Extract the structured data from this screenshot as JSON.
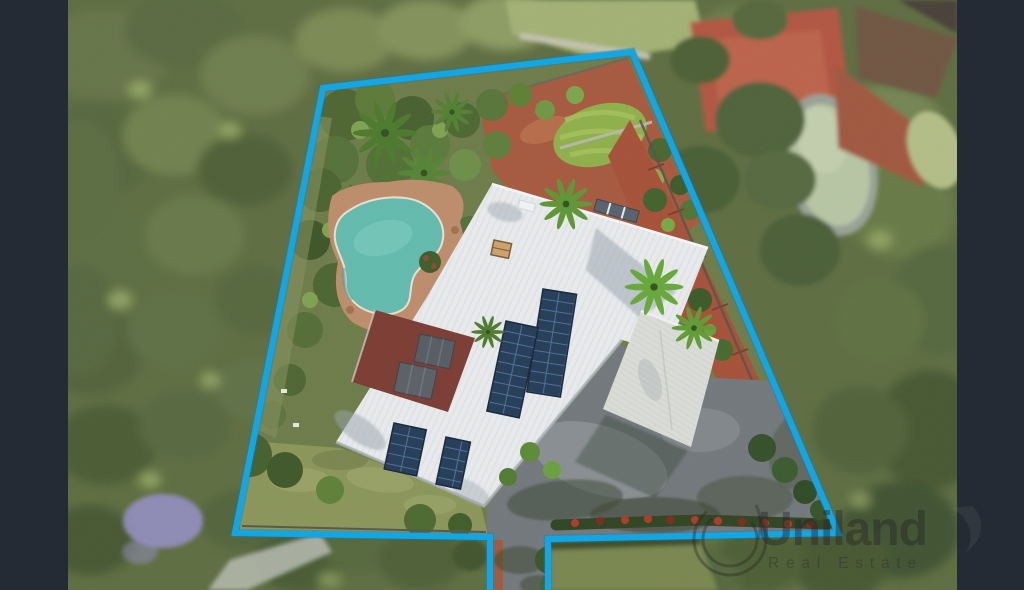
{
  "image": {
    "kind": "aerial drone photograph of a residential property with highlighted lot boundary",
    "width": 1024,
    "height": 590
  },
  "watermark": {
    "brand": "Uniland",
    "tagline": "Real Estate"
  },
  "colors": {
    "frame_bar": "#242b34",
    "boundary": "#14a5e3",
    "house_roof": "#e9ebed",
    "garage_roof": "#dadcd7",
    "solar_panel": "#253c58",
    "pool_water": "#63bbae",
    "pool_paving": "#bd8d6c",
    "pergola_roof": "#7b3c33",
    "driveway": "#73787c",
    "mulch": "#a75a3f",
    "putting_green": "#8fb04c",
    "lawn": "#8b965a",
    "foliage": "#5e6e41",
    "jacaranda": "#948ec2",
    "neighbor_court": "#b25742",
    "neighbor_pond": "#b7c6a4",
    "neighbor_roof": "#6f5743",
    "watermark_ink": "rgba(40,40,40,0.45)"
  },
  "scene": {
    "features": [
      "blurred tree-lined surroundings",
      "blue highlighted property boundary with driveway access notch at bottom",
      "main house with white metal roof and rooftop solar arrays",
      "detached garage with grey tiled roof",
      "kidney-shaped swimming pool with paved surround",
      "putting green and terracotta mulch gardens",
      "asphalt driveway and parking court with tree shadows",
      "jacaranda tree lower left",
      "neighbouring red court, pond and roofs at top right"
    ]
  }
}
